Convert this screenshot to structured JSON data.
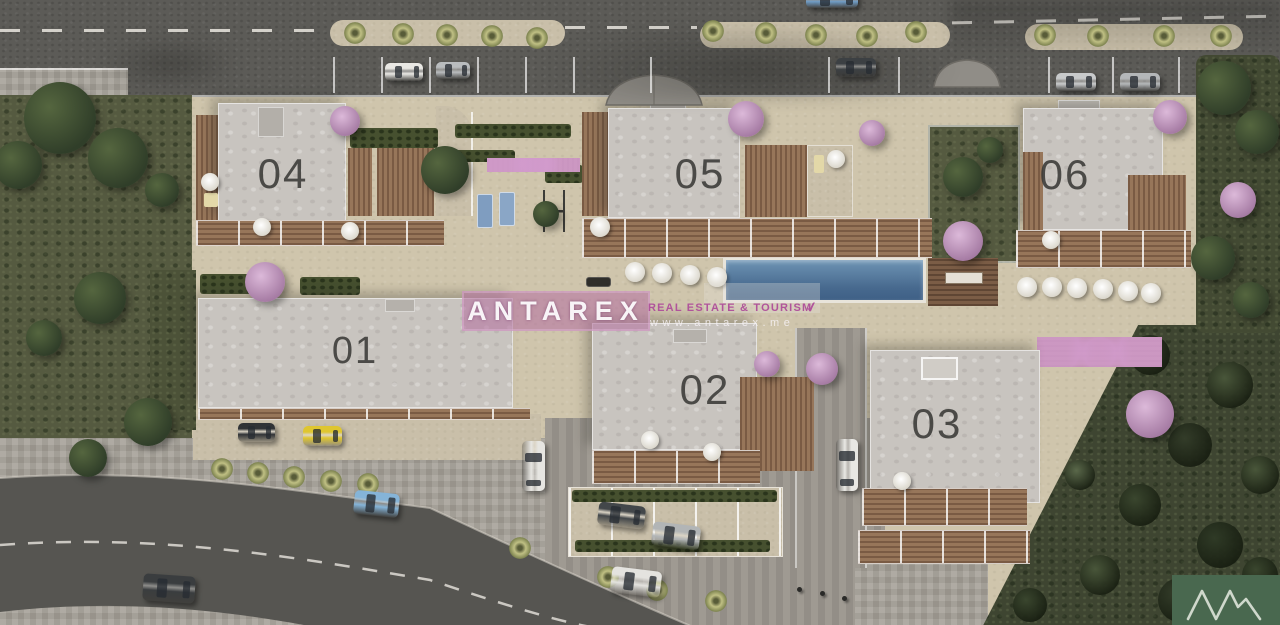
{
  "scene_title": "Aerial site plan render of residential complex",
  "buildings": [
    {
      "id": "building-01",
      "label": "01"
    },
    {
      "id": "building-02",
      "label": "02"
    },
    {
      "id": "building-03",
      "label": "03"
    },
    {
      "id": "building-04",
      "label": "04"
    },
    {
      "id": "building-05",
      "label": "05"
    },
    {
      "id": "building-06",
      "label": "06"
    }
  ],
  "watermark": {
    "brand": "ANTAREX",
    "tagline": "REAL ESTATE & TOURISM",
    "website": "www.antarex.me",
    "swoosh": "✓"
  },
  "logo": {
    "name": "mountain-peaks-logo",
    "background": "#49684f",
    "stroke": "#cfd8cc"
  },
  "palette": {
    "asphalt": "#5c5b57",
    "stone_paving": "#cfc5ac",
    "cobble": "#a8a39a",
    "roof_gray": "#c8c4bf",
    "deck_wood": "#8a6a50",
    "pool_blue": "#54789e",
    "grass_green": "#555a40",
    "forest_green": "#3e4531",
    "flower_pink": "#c09ebd",
    "watermark_pink": "#b674a2",
    "logo_green": "#49684f",
    "car_yellow": "#dfc62f",
    "car_blue": "#85b4d8"
  }
}
